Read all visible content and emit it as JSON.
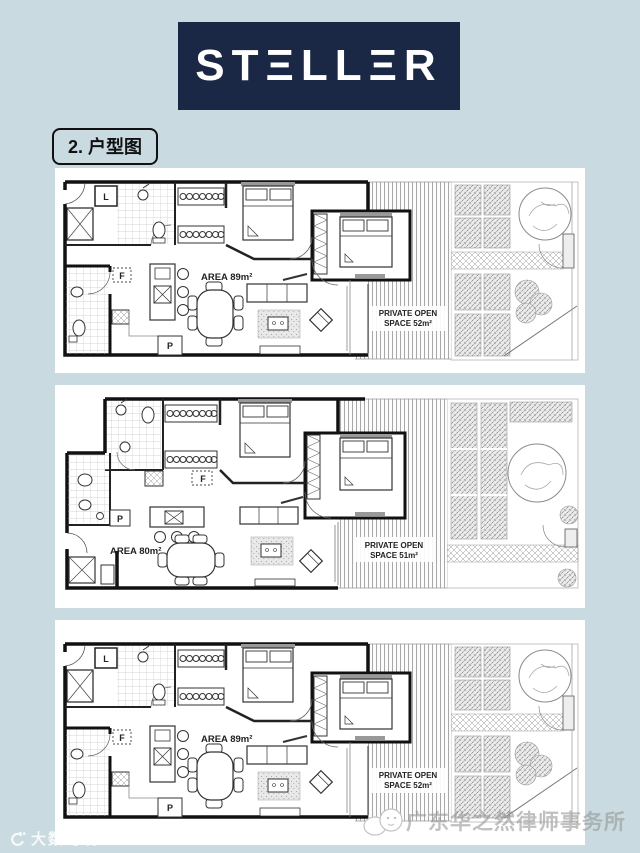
{
  "logo": {
    "name": "STELLER",
    "display": "STΞLLΞR",
    "bg_color": "#1a2845",
    "text_color": "#ffffff"
  },
  "section": {
    "title": "2. 户型图"
  },
  "plans": [
    {
      "id": "floorplan-top",
      "area_label": "AREA 89m²",
      "open_space_line1": "PRIVATE OPEN",
      "open_space_line2": "SPACE 52m²",
      "letters": {
        "laundry": "L",
        "fridge": "F",
        "pantry": "P"
      }
    },
    {
      "id": "floorplan-middle",
      "area_label": "AREA 80m²",
      "open_space_line1": "PRIVATE OPEN",
      "open_space_line2": "SPACE 51m²",
      "letters": {
        "fridge": "F",
        "pantry": "P"
      }
    },
    {
      "id": "floorplan-bottom",
      "area_label": "AREA 89m²",
      "open_space_line1": "PRIVATE OPEN",
      "open_space_line2": "SPACE 52m²",
      "letters": {
        "laundry": "L",
        "fridge": "F",
        "pantry": "P"
      }
    }
  ],
  "watermarks": {
    "left": "大数跨境",
    "right": "广东华之然律师事务所"
  },
  "colors": {
    "page_background": "#c9dbe0",
    "panel_background": "#ffffff",
    "plan_line": "#111111"
  }
}
